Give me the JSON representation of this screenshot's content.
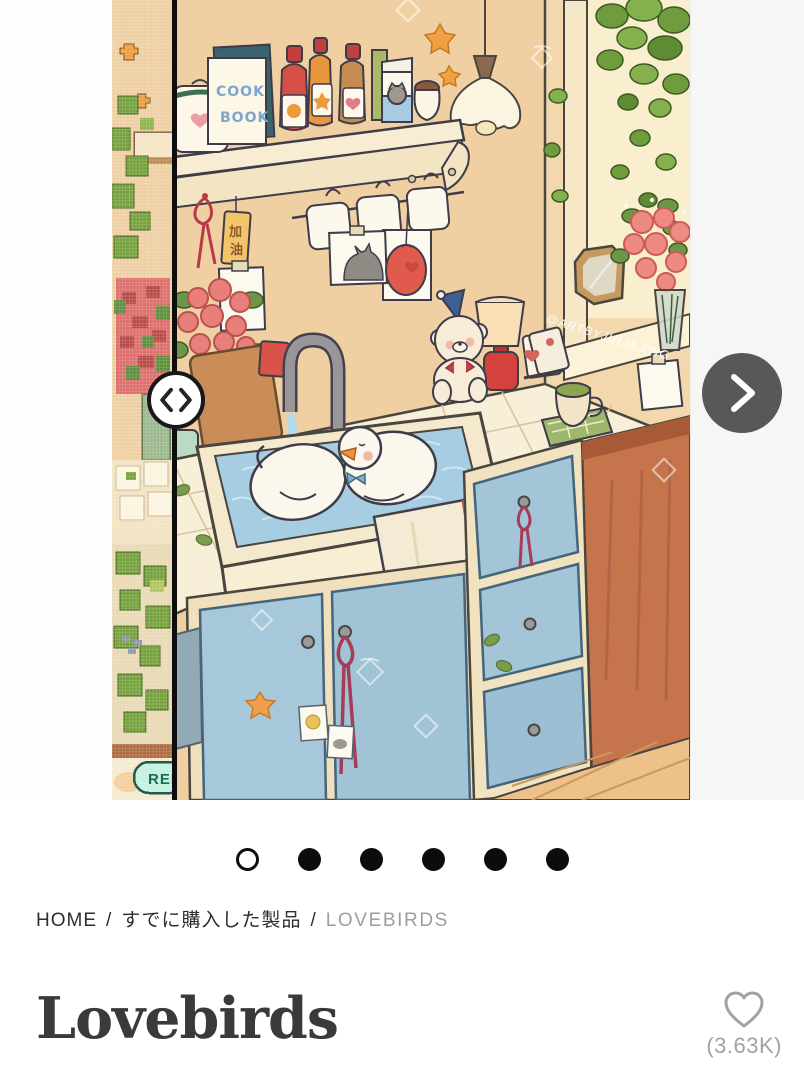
{
  "carousel": {
    "compare_slider": {
      "icon": "chevron-left-right",
      "divider_color": "#0e0e0e"
    },
    "next_button": {
      "icon": "chevron-right",
      "bg": "#58585a"
    },
    "render_button": {
      "label": "REN"
    },
    "dots": {
      "count": 6,
      "active_index": 0
    },
    "artwork": {
      "watermark": "@ARTBYJULIA.PNG",
      "cookbook_title_line1": "COOK",
      "cookbook_title_line2": "BOOK",
      "cakes_label": "CAKES",
      "tag_text_top": "加",
      "tag_text_bottom": "油"
    }
  },
  "breadcrumb": {
    "separator": "/",
    "items": [
      {
        "label": "HOME",
        "current": false
      },
      {
        "label": "すでに購入した製品",
        "current": false
      },
      {
        "label": "LOVEBIRDS",
        "current": true
      }
    ]
  },
  "product": {
    "title": "Lovebirds",
    "likes_count": "(3.63K)"
  },
  "colors": {
    "wall_peach": "#f0d0a3",
    "cabinet_blue": "#a6c8da",
    "mint_button_bg": "#c7f1e1",
    "mint_button_text": "#1d6a58",
    "accent_dark": "#0c0c0c",
    "muted_text": "#9e9e9e",
    "rust_wall": "#c5744c"
  }
}
